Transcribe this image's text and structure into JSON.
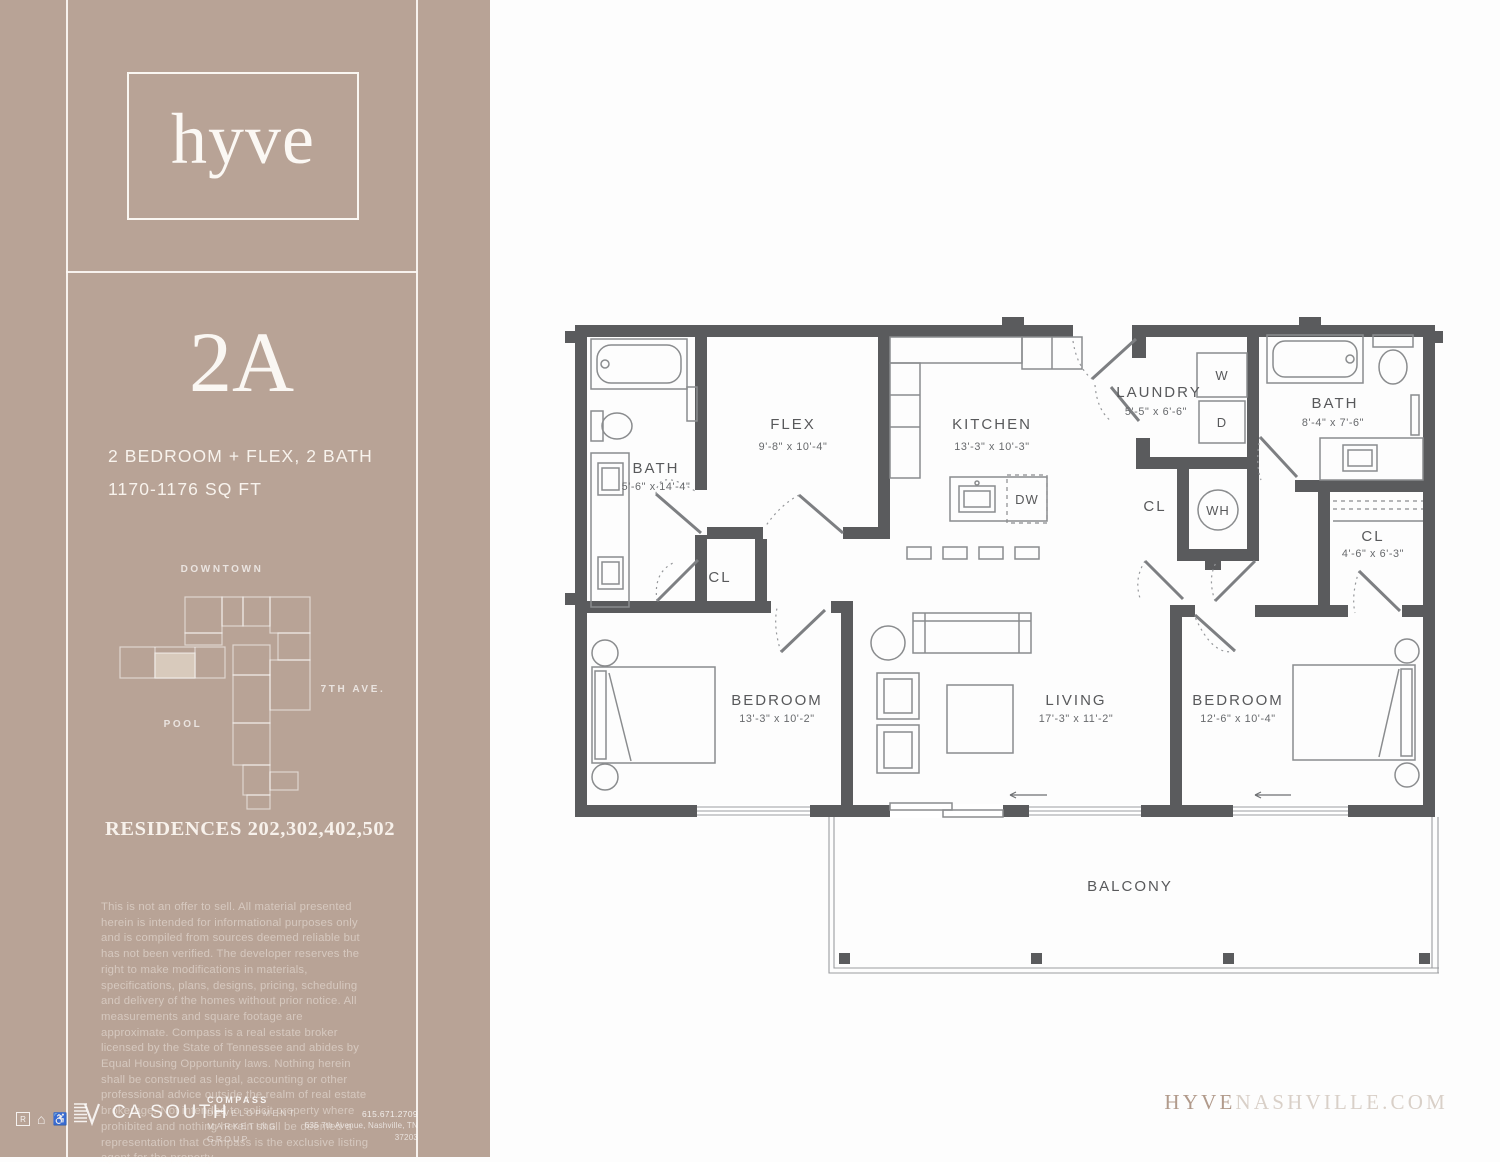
{
  "sidebar": {
    "logo": "hyve",
    "unit": {
      "name": "2A",
      "spec_line1": "2 BEDROOM + FLEX,  2 BATH",
      "spec_line2": "1170-1176 SQ FT"
    },
    "site_map": {
      "downtown": "DOWNTOWN",
      "avenue": "7TH AVE.",
      "pool": "POOL"
    },
    "residences": "RESIDENCES 202,302,402,502",
    "disclaimer": "This is not an offer to sell. All material presented herein is intended for informational purposes only and is compiled from sources deemed reliable but has not been verified. The developer reserves the right to make modifications in materials, specifications, plans, designs, pricing, scheduling and delivery of the homes without prior notice. All measurements and square footage are approximate. Compass is a real estate broker licensed by the State of Tennessee and abides by Equal Housing Opportunity laws. Nothing herein shall be construed as legal, accounting or other professional advice outside the realm of real estate brokerage. Not intended to solicit property where prohibited and nothing herein shall be deemed a representation that Compass is the exclusive listing agent for the property.",
    "footer": {
      "ca_south": "CA SOUTH",
      "compass_lines": [
        "COMPASS",
        "DEVELOPMENT",
        "MARKETING",
        "GROUP"
      ],
      "phone": "615.671.2709",
      "address": "635 7th Avenue, Nashville, TN 37203"
    }
  },
  "floorplan": {
    "bath1": {
      "label": "BATH",
      "dims": "5'-6\" x 14'-4\""
    },
    "flex": {
      "label": "FLEX",
      "dims": "9'-8\" x 10'-4\""
    },
    "kitchen": {
      "label": "KITCHEN",
      "dims": "13'-3\" x 10'-3\""
    },
    "laundry": {
      "label": "LAUNDRY",
      "dims": "5'-5\" x 6'-6\""
    },
    "bath2": {
      "label": "BATH",
      "dims": "8'-4\" x 7'-6\""
    },
    "cl_hall": {
      "label": "CL"
    },
    "cl_utility": {
      "label": "CL"
    },
    "cl_bedroom2": {
      "label": "CL",
      "dims": "4'-6\" x 6'-3\""
    },
    "bedroom1": {
      "label": "BEDROOM",
      "dims": "13'-3\" x 10'-2\""
    },
    "living": {
      "label": "LIVING",
      "dims": "17'-3\" x 11'-2\""
    },
    "bedroom2": {
      "label": "BEDROOM",
      "dims": "12'-6\" x 10'-4\""
    },
    "balcony": {
      "label": "BALCONY"
    },
    "appliances": {
      "washer": "W",
      "dryer": "D",
      "water_heater": "WH",
      "dishwasher": "DW"
    }
  },
  "website": {
    "brand": "HYVE",
    "suffix": "NASHVILLE.COM"
  },
  "colors": {
    "sidebar_tan": "#b8a396",
    "highlight_unit": "#d8cabc",
    "wall_gray": "#5a5b5d"
  }
}
